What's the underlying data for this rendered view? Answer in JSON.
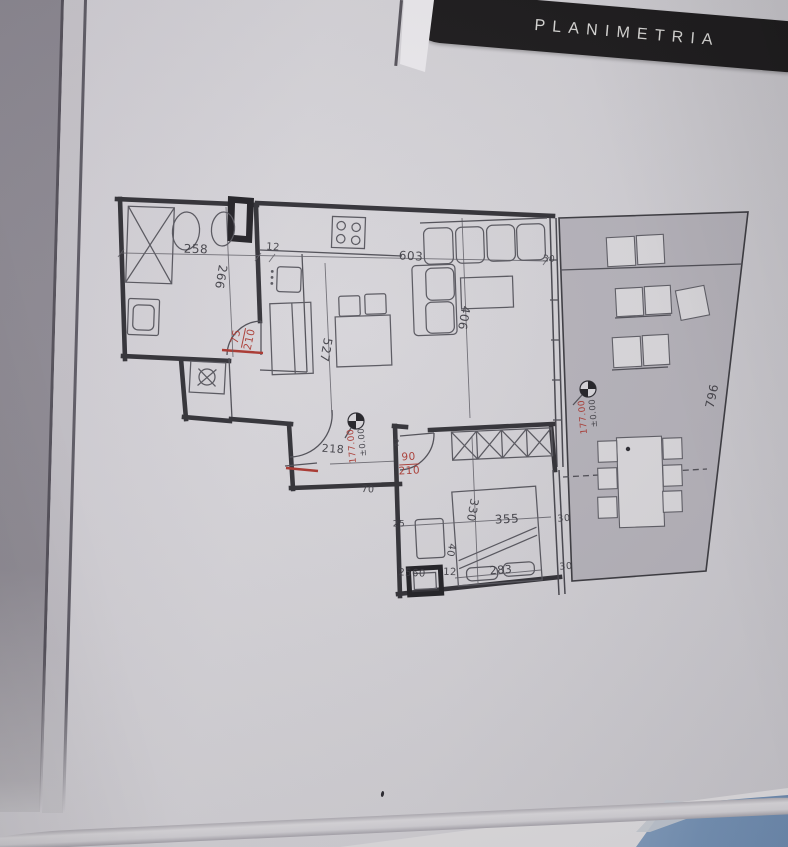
{
  "header": {
    "title": "PLANIMETRIA"
  },
  "colors": {
    "dim_dark": "#3b3a41",
    "dim_red": "#a8332c",
    "banner_bg": "#1a181a",
    "banner_text": "#d9d8d6",
    "terrace_fill": "#b4b1b9",
    "next_page_blue": "#7b98bb"
  },
  "plan": {
    "labels": [
      {
        "name": "dim-bath-width",
        "text": "258",
        "x": 196,
        "y": 249,
        "rot": 2,
        "fs": 12
      },
      {
        "name": "dim-bath-depth",
        "text": "266",
        "x": 221,
        "y": 277,
        "rot": 100,
        "fs": 12
      },
      {
        "name": "dim-wall-12-bath",
        "text": "12",
        "x": 273,
        "y": 248,
        "rot": 4,
        "fs": 10
      },
      {
        "name": "dim-living-width",
        "text": "603",
        "x": 411,
        "y": 256,
        "rot": 3,
        "fs": 12
      },
      {
        "name": "dim-window-30-top",
        "text": "30",
        "x": 549,
        "y": 260,
        "rot": 3,
        "fs": 9
      },
      {
        "name": "dim-living-depth",
        "text": "406",
        "x": 464,
        "y": 318,
        "rot": 100,
        "fs": 12
      },
      {
        "name": "dim-living-length",
        "text": "527",
        "x": 326,
        "y": 350,
        "rot": 100,
        "fs": 12
      },
      {
        "name": "dim-bath-door",
        "lines": [
          "75",
          "210"
        ],
        "x": 243,
        "y": 338,
        "rot": -78,
        "fs": 10.5,
        "color": "red"
      },
      {
        "name": "dim-entry-door",
        "text": "218",
        "x": 333,
        "y": 449,
        "rot": 4,
        "fs": 11
      },
      {
        "name": "level-entry-relative",
        "text": "±0.00",
        "x": 363,
        "y": 442,
        "rot": -95,
        "fs": 8.5
      },
      {
        "name": "level-entry-absolute",
        "text": "177.00",
        "x": 353,
        "y": 446,
        "rot": -95,
        "fs": 9,
        "color": "red"
      },
      {
        "name": "dim-wall-2",
        "text": "2",
        "x": 397,
        "y": 444,
        "rot": 0,
        "fs": 9
      },
      {
        "name": "dim-bedroom-door",
        "lines": [
          "90",
          "210"
        ],
        "x": 409,
        "y": 464,
        "rot": -3,
        "fs": 10.5,
        "color": "red"
      },
      {
        "name": "dim-entry-width",
        "text": "70",
        "x": 368,
        "y": 490,
        "rot": 2,
        "fs": 9.5
      },
      {
        "name": "dim-bedroom-corner",
        "text": "2560",
        "x": 412,
        "y": 574,
        "rot": 3,
        "fs": 10
      },
      {
        "name": "dim-wall-12-bedroom",
        "text": "12",
        "x": 450,
        "y": 573,
        "rot": 2,
        "fs": 10
      },
      {
        "name": "dim-bed-width",
        "text": "283",
        "x": 501,
        "y": 570,
        "rot": -4,
        "fs": 11
      },
      {
        "name": "dim-bedroom-width",
        "text": "355",
        "x": 507,
        "y": 519,
        "rot": -3,
        "fs": 12
      },
      {
        "name": "dim-bedroom-depth",
        "text": "330",
        "x": 472,
        "y": 510,
        "rot": 100,
        "fs": 11.5
      },
      {
        "name": "dim-bedside-gap",
        "text": "40",
        "x": 450,
        "y": 550,
        "rot": 100,
        "fs": 10
      },
      {
        "name": "dim-wall-25",
        "text": "25",
        "x": 399,
        "y": 525,
        "rot": 0,
        "fs": 9
      },
      {
        "name": "dim-window-30-mid",
        "text": "30",
        "x": 564,
        "y": 519,
        "rot": -5,
        "fs": 9.5
      },
      {
        "name": "dim-window-30-bottom",
        "text": "30",
        "x": 566,
        "y": 567,
        "rot": -5,
        "fs": 9.5
      },
      {
        "name": "dim-terrace-length",
        "text": "796",
        "x": 712,
        "y": 396,
        "rot": -78,
        "fs": 12
      },
      {
        "name": "level-terrace-relative",
        "text": "±0.00",
        "x": 594,
        "y": 413,
        "rot": -95,
        "fs": 8.5
      },
      {
        "name": "level-terrace-absolute",
        "text": "177.00",
        "x": 584,
        "y": 417,
        "rot": -95,
        "fs": 9,
        "color": "red"
      }
    ]
  }
}
